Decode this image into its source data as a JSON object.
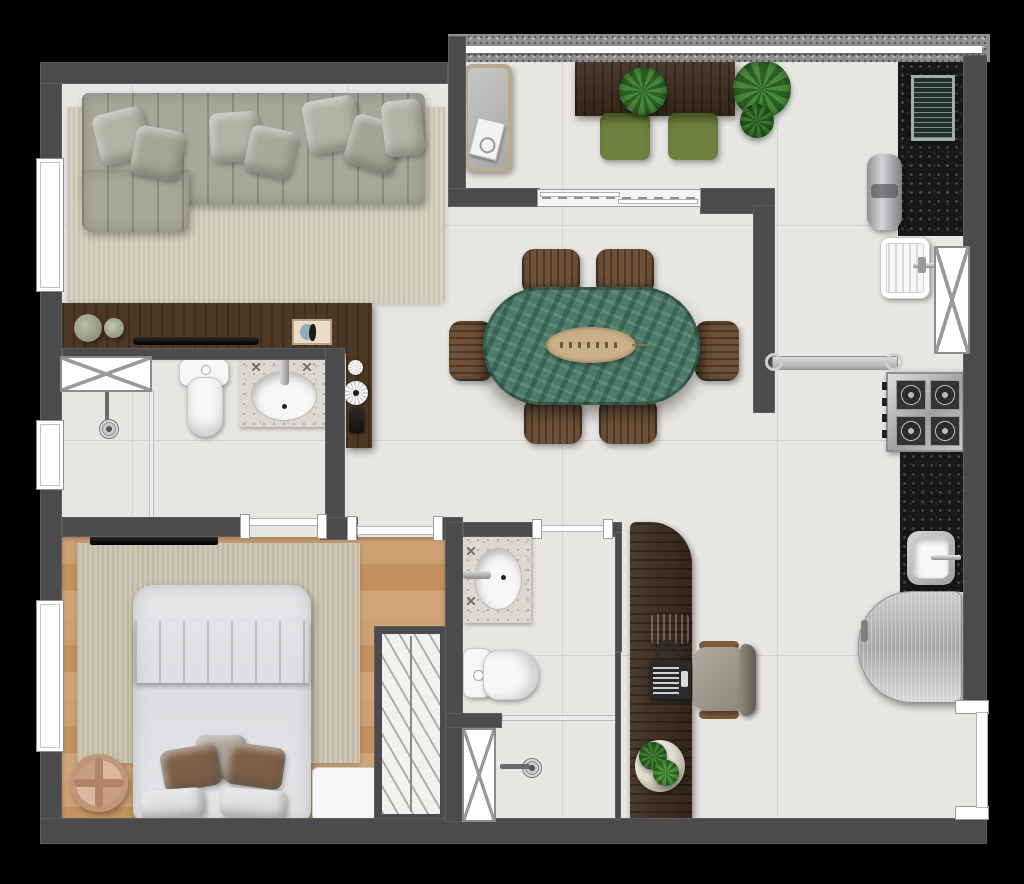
{
  "meta": {
    "image_type": "top-down 3D rendered apartment floor plan",
    "canvas": {
      "width": 1024,
      "height": 884
    },
    "background": "#000000",
    "visible_text": "none"
  },
  "palette": {
    "walls": "#4b4b4d",
    "tile_floor": "#e8e6e2",
    "tile_grout": "#d6d3ce",
    "wood_floor": "#c79a6b",
    "living_rug": "#d8d1c1",
    "bedroom_rug": "#cfc7b5",
    "sofa_fabric": "#a8a89a",
    "dark_walnut": "#3e2d1f",
    "console_wood": "#4e3926",
    "black_granite": "#181818",
    "granite_parapet": "#8f8f8f",
    "green_marble_table": "#4e7b69",
    "dining_chair_brown": "#6f5239",
    "balcony_chair_green": "#6f8140",
    "stainless_steel": "#c6c6c8",
    "white_fixture": "#f7f7f7",
    "vanity_marble": "#dcd7cf",
    "blanket_brown": "#83614b",
    "pouf_copper": "#c1977c",
    "plant_green": "#49883a",
    "glass_frame_white": "#ffffff"
  },
  "rooms": [
    {
      "id": "living-room",
      "items": [
        {
          "name": "sectional-sofa",
          "count": 1
        },
        {
          "name": "throw-pillow",
          "count": 7
        },
        {
          "name": "area-rug",
          "count": 1
        },
        {
          "name": "media-console",
          "count": 1
        },
        {
          "name": "decor-vase",
          "count": 2
        },
        {
          "name": "soundbar",
          "count": 1
        },
        {
          "name": "decor-frame",
          "count": 1
        },
        {
          "name": "wood-side-panel",
          "count": 1
        },
        {
          "name": "decor-plate",
          "count": 2
        },
        {
          "name": "panel-handle",
          "count": 1
        },
        {
          "name": "window",
          "count": 1
        }
      ]
    },
    {
      "id": "gourmet-balcony",
      "items": [
        {
          "name": "granite-parapet-with-glass-railing",
          "count": 1
        },
        {
          "name": "daybed-bench",
          "count": 1
        },
        {
          "name": "book",
          "count": 1
        },
        {
          "name": "walnut-table",
          "count": 1
        },
        {
          "name": "table-plant",
          "count": 1
        },
        {
          "name": "green-chair",
          "count": 2
        },
        {
          "name": "potted-plant",
          "count": 1
        },
        {
          "name": "sliding-glass-door",
          "count": 1
        }
      ]
    },
    {
      "id": "service-area",
      "items": [
        {
          "name": "black-granite-grill-counter",
          "count": 1
        },
        {
          "name": "barbecue-grill",
          "count": 1
        },
        {
          "name": "water-heater",
          "count": 1
        },
        {
          "name": "laundry-tub",
          "count": 1
        },
        {
          "name": "ventilation-shaft-window",
          "count": 1
        },
        {
          "name": "sliding-glass-door",
          "count": 1
        }
      ]
    },
    {
      "id": "dining-area",
      "items": [
        {
          "name": "oval-green-marble-table",
          "count": 1
        },
        {
          "name": "leaf-centerpiece",
          "count": 1
        },
        {
          "name": "dining-chair",
          "count": 6
        }
      ]
    },
    {
      "id": "kitchen",
      "items": [
        {
          "name": "four-burner-cooktop",
          "count": 1
        },
        {
          "name": "black-granite-counter",
          "count": 1
        },
        {
          "name": "stainless-sink",
          "count": 1
        },
        {
          "name": "refrigerator",
          "count": 1
        },
        {
          "name": "entry-door-opening",
          "count": 1
        }
      ]
    },
    {
      "id": "bedroom",
      "items": [
        {
          "name": "double-bed",
          "count": 1
        },
        {
          "name": "runner-blanket",
          "count": 1
        },
        {
          "name": "bed-pillow",
          "count": 5
        },
        {
          "name": "area-rug",
          "count": 1
        },
        {
          "name": "wall-tv",
          "count": 1
        },
        {
          "name": "round-pouf",
          "count": 1
        },
        {
          "name": "bedroom-bench",
          "count": 1
        },
        {
          "name": "open-wardrobe",
          "count": 1
        },
        {
          "name": "window",
          "count": 1
        },
        {
          "name": "door-opening",
          "count": 1
        }
      ]
    },
    {
      "id": "bathroom-1",
      "items": [
        {
          "name": "shower-area",
          "count": 1
        },
        {
          "name": "floor-drain",
          "count": 1
        },
        {
          "name": "glass-partition",
          "count": 1
        },
        {
          "name": "toilet",
          "count": 1
        },
        {
          "name": "granite-vanity-sink",
          "count": 1
        },
        {
          "name": "cabinet-shaft-hatch",
          "count": 1
        },
        {
          "name": "window",
          "count": 1
        },
        {
          "name": "door-opening",
          "count": 1
        }
      ]
    },
    {
      "id": "bathroom-2",
      "items": [
        {
          "name": "granite-vanity-sink",
          "count": 1
        },
        {
          "name": "toilet",
          "count": 1
        },
        {
          "name": "shower-area",
          "count": 1
        },
        {
          "name": "floor-drain",
          "count": 1
        },
        {
          "name": "glass-partition",
          "count": 1
        },
        {
          "name": "ventilation-shaft-hatch",
          "count": 1
        },
        {
          "name": "door-opening",
          "count": 1
        }
      ]
    },
    {
      "id": "home-office",
      "items": [
        {
          "name": "curved-desk",
          "count": 1
        },
        {
          "name": "laptop",
          "count": 1
        },
        {
          "name": "headphones",
          "count": 1
        },
        {
          "name": "desk-device",
          "count": 1
        },
        {
          "name": "desk-plant",
          "count": 1
        },
        {
          "name": "office-chair",
          "count": 1
        }
      ]
    }
  ]
}
